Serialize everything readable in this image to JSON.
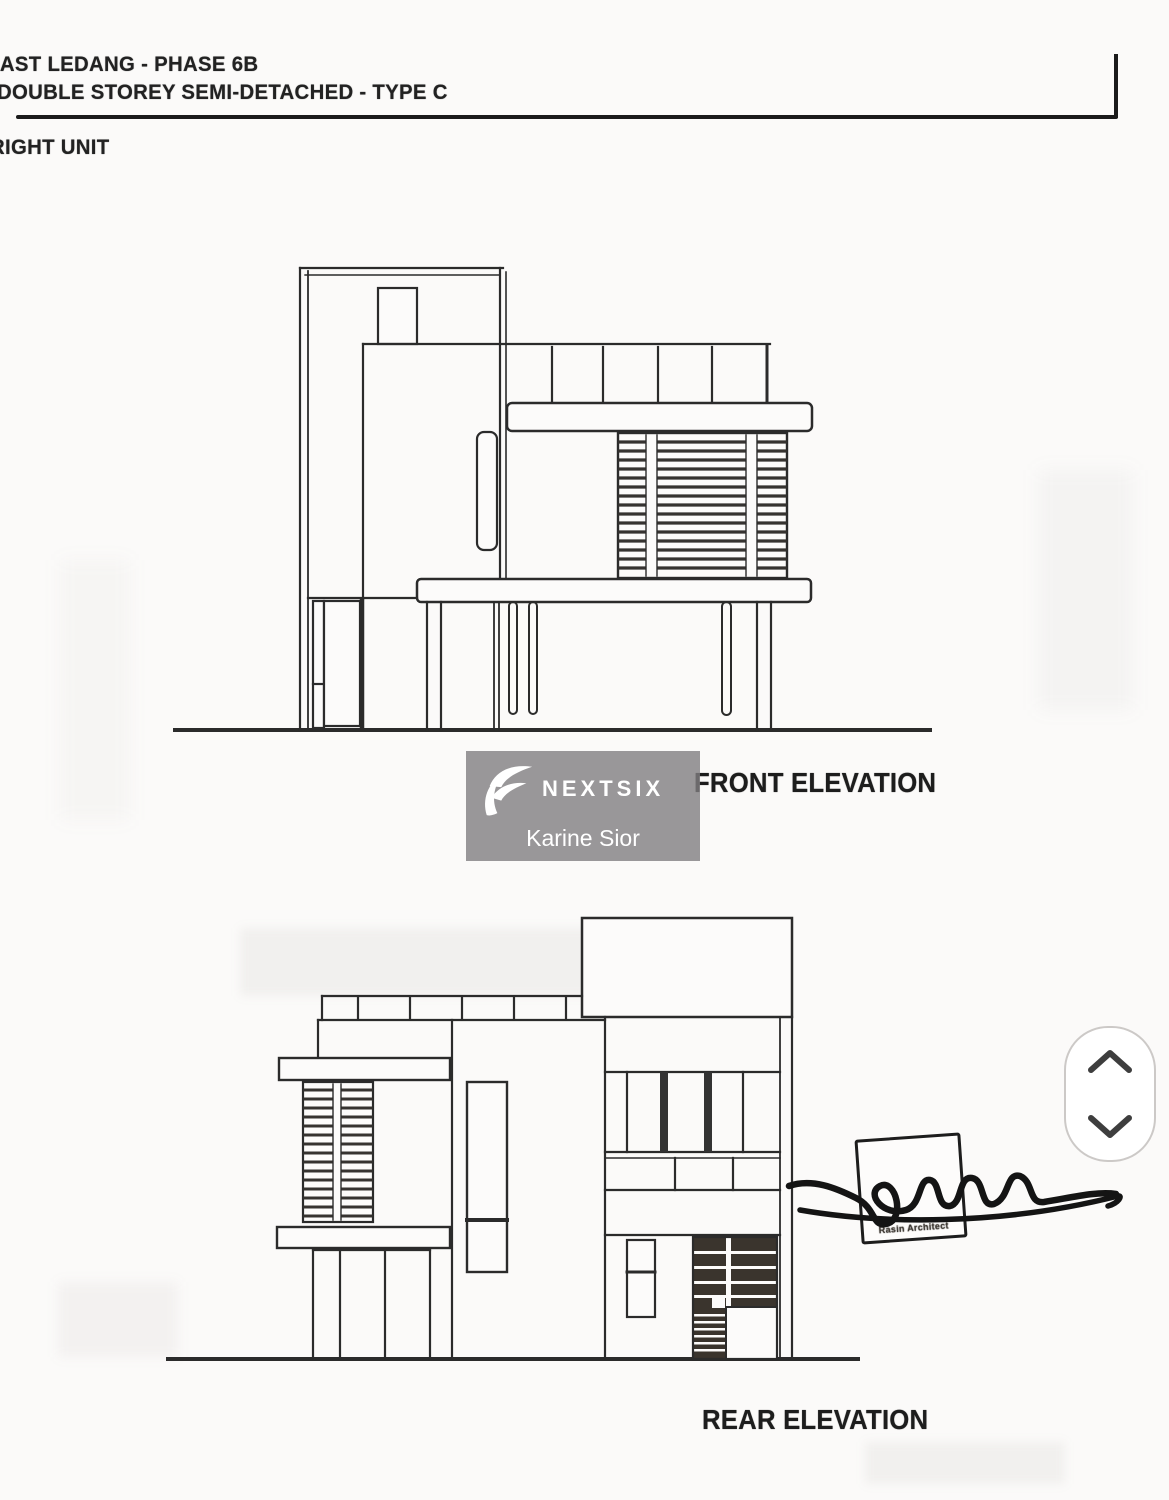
{
  "header": {
    "project_line1": "EAST LEDANG - PHASE 6B",
    "project_line2": "DOUBLE STOREY SEMI-DETACHED - TYPE C",
    "unit_label": "RIGHT UNIT"
  },
  "drawings": {
    "front": {
      "label": "FRONT ELEVATION"
    },
    "rear": {
      "label": "REAR ELEVATION"
    }
  },
  "watermark": {
    "brand": "NEXTSIX",
    "agent": "Karine Sior",
    "icon": "nextsix-wing-icon",
    "panel_color": "#a5a2a5",
    "text_color": "#ffffff"
  },
  "stamp": {
    "caption": "Rasin Architect"
  },
  "scroll_widget": {
    "up_icon": "chevron-up-icon",
    "down_icon": "chevron-down-icon"
  },
  "colors": {
    "ink": "#2b2b2b",
    "paper": "#fbfaf9"
  }
}
